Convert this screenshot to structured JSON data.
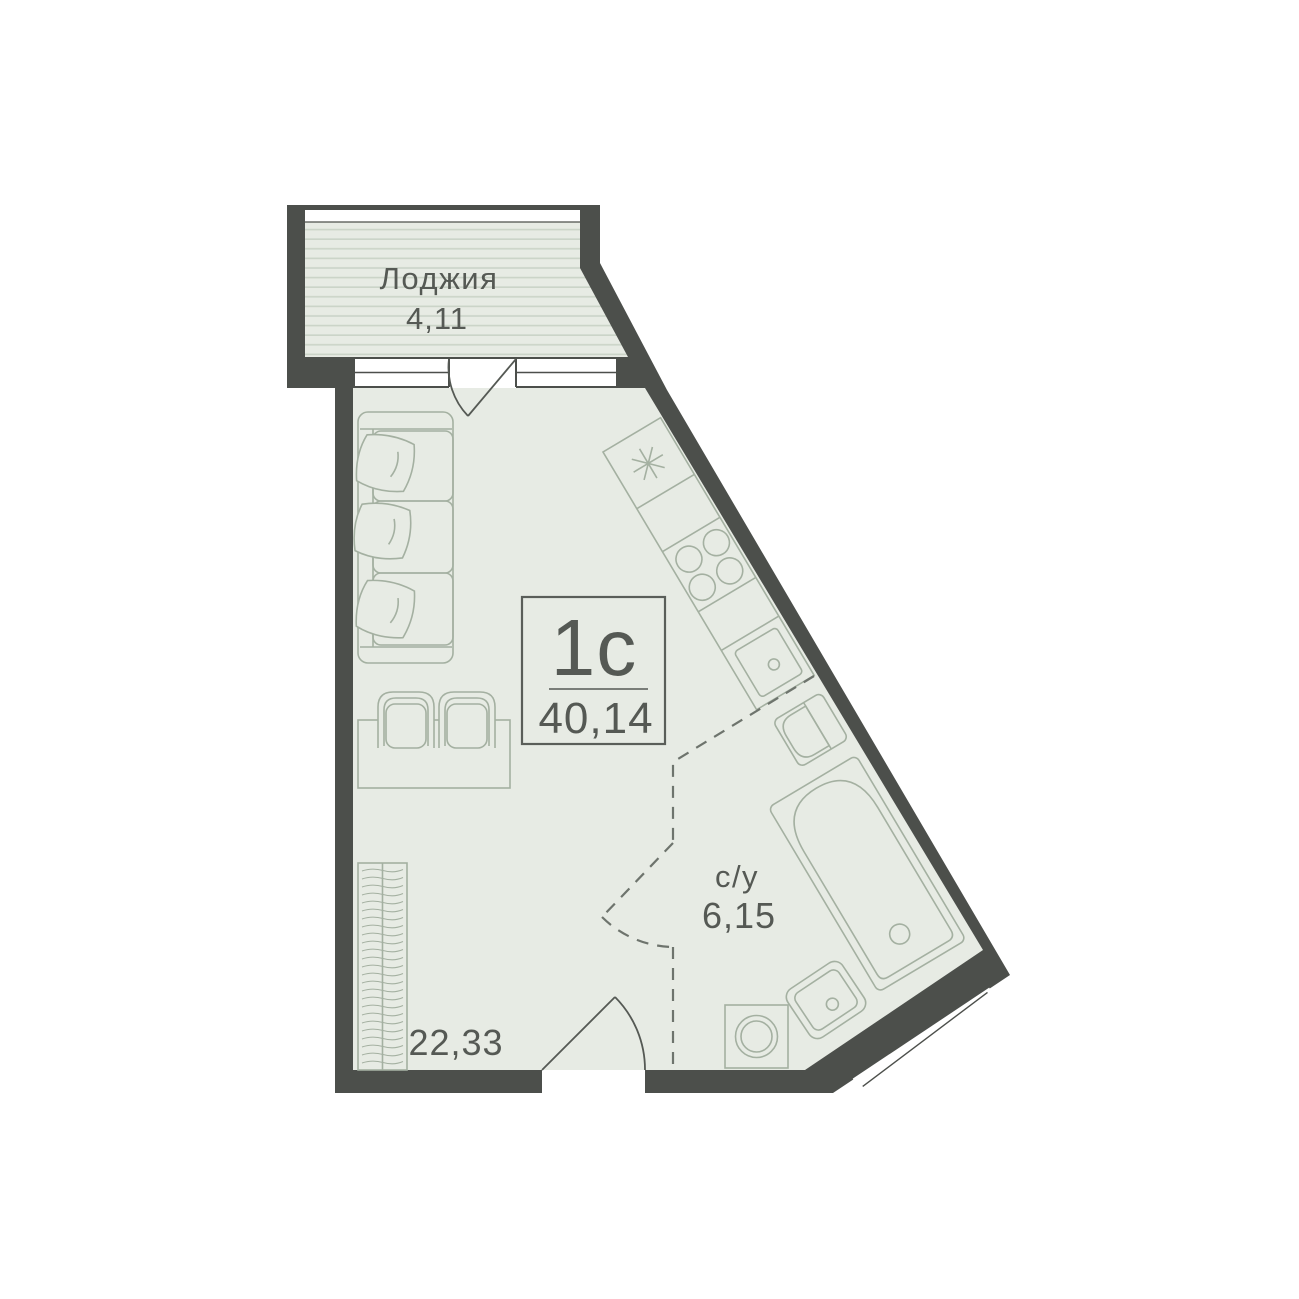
{
  "unit_card": {
    "type_label": "1с",
    "total_area": "40,14"
  },
  "rooms": {
    "loggia": {
      "label": "Лоджия",
      "area": "4,11"
    },
    "bathroom": {
      "label": "с/у",
      "area": "6,15"
    },
    "living_kitchen": {
      "area": "22,33"
    }
  },
  "colors": {
    "wall": "#4c4f4b",
    "floor": "#e7ebe4",
    "loggia_stripe": "#cbd4c8",
    "furniture_line": "#a4b0a1",
    "dashed_line": "#6e746d",
    "text": "#555954",
    "box_border": "#5a5e59",
    "background": "#ffffff"
  }
}
